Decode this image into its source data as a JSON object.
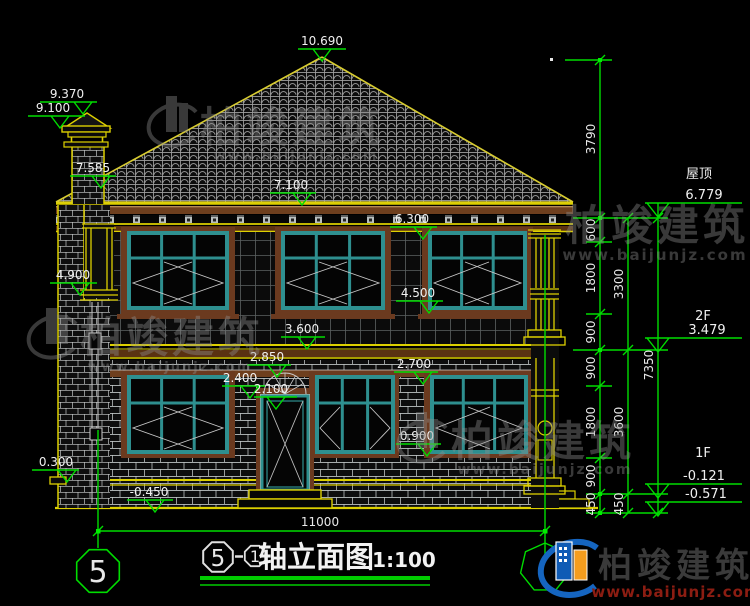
{
  "title_block": {
    "axis_start": "5",
    "axis_end": "1",
    "title": "轴立面图",
    "scale": "1:100"
  },
  "axis": {
    "left_bubble": "5"
  },
  "dims": {
    "bottom_width": "11000",
    "chain1": [
      "3790",
      "600",
      "1800",
      "900",
      "900",
      "1800",
      "900",
      "450"
    ],
    "chain2": [
      "3300",
      "3600",
      "450"
    ],
    "chain3": [
      "7350"
    ]
  },
  "levels": {
    "peak": "10.690",
    "chimney_top": "9.370",
    "chimney_cap": "9.100",
    "eave_left": "7.585",
    "eave": "7.100",
    "win2f_top": "6.300",
    "column_cap": "4.900",
    "win2f_sill": "4.500",
    "band_2f": "3.600",
    "belt_1f": "2.850",
    "arch_top": "2.400",
    "door_top": "2.100",
    "win1f_top": "2.700",
    "win1f_sill": "0.900",
    "ledge": "0.300",
    "ground": "-0.450"
  },
  "floors": {
    "roof_label": "屋顶",
    "roof_level": "6.779",
    "f2_label": "2F",
    "f2_level": "3.479",
    "f1_label": "1F",
    "f1_level": "-0.121",
    "base_level": "-0.571"
  },
  "watermark": {
    "brand": "柏竣建筑",
    "url": "www.baijunjz.com"
  },
  "logo": {
    "brand": "柏竣建筑",
    "url": "www.baijunjz.com"
  }
}
